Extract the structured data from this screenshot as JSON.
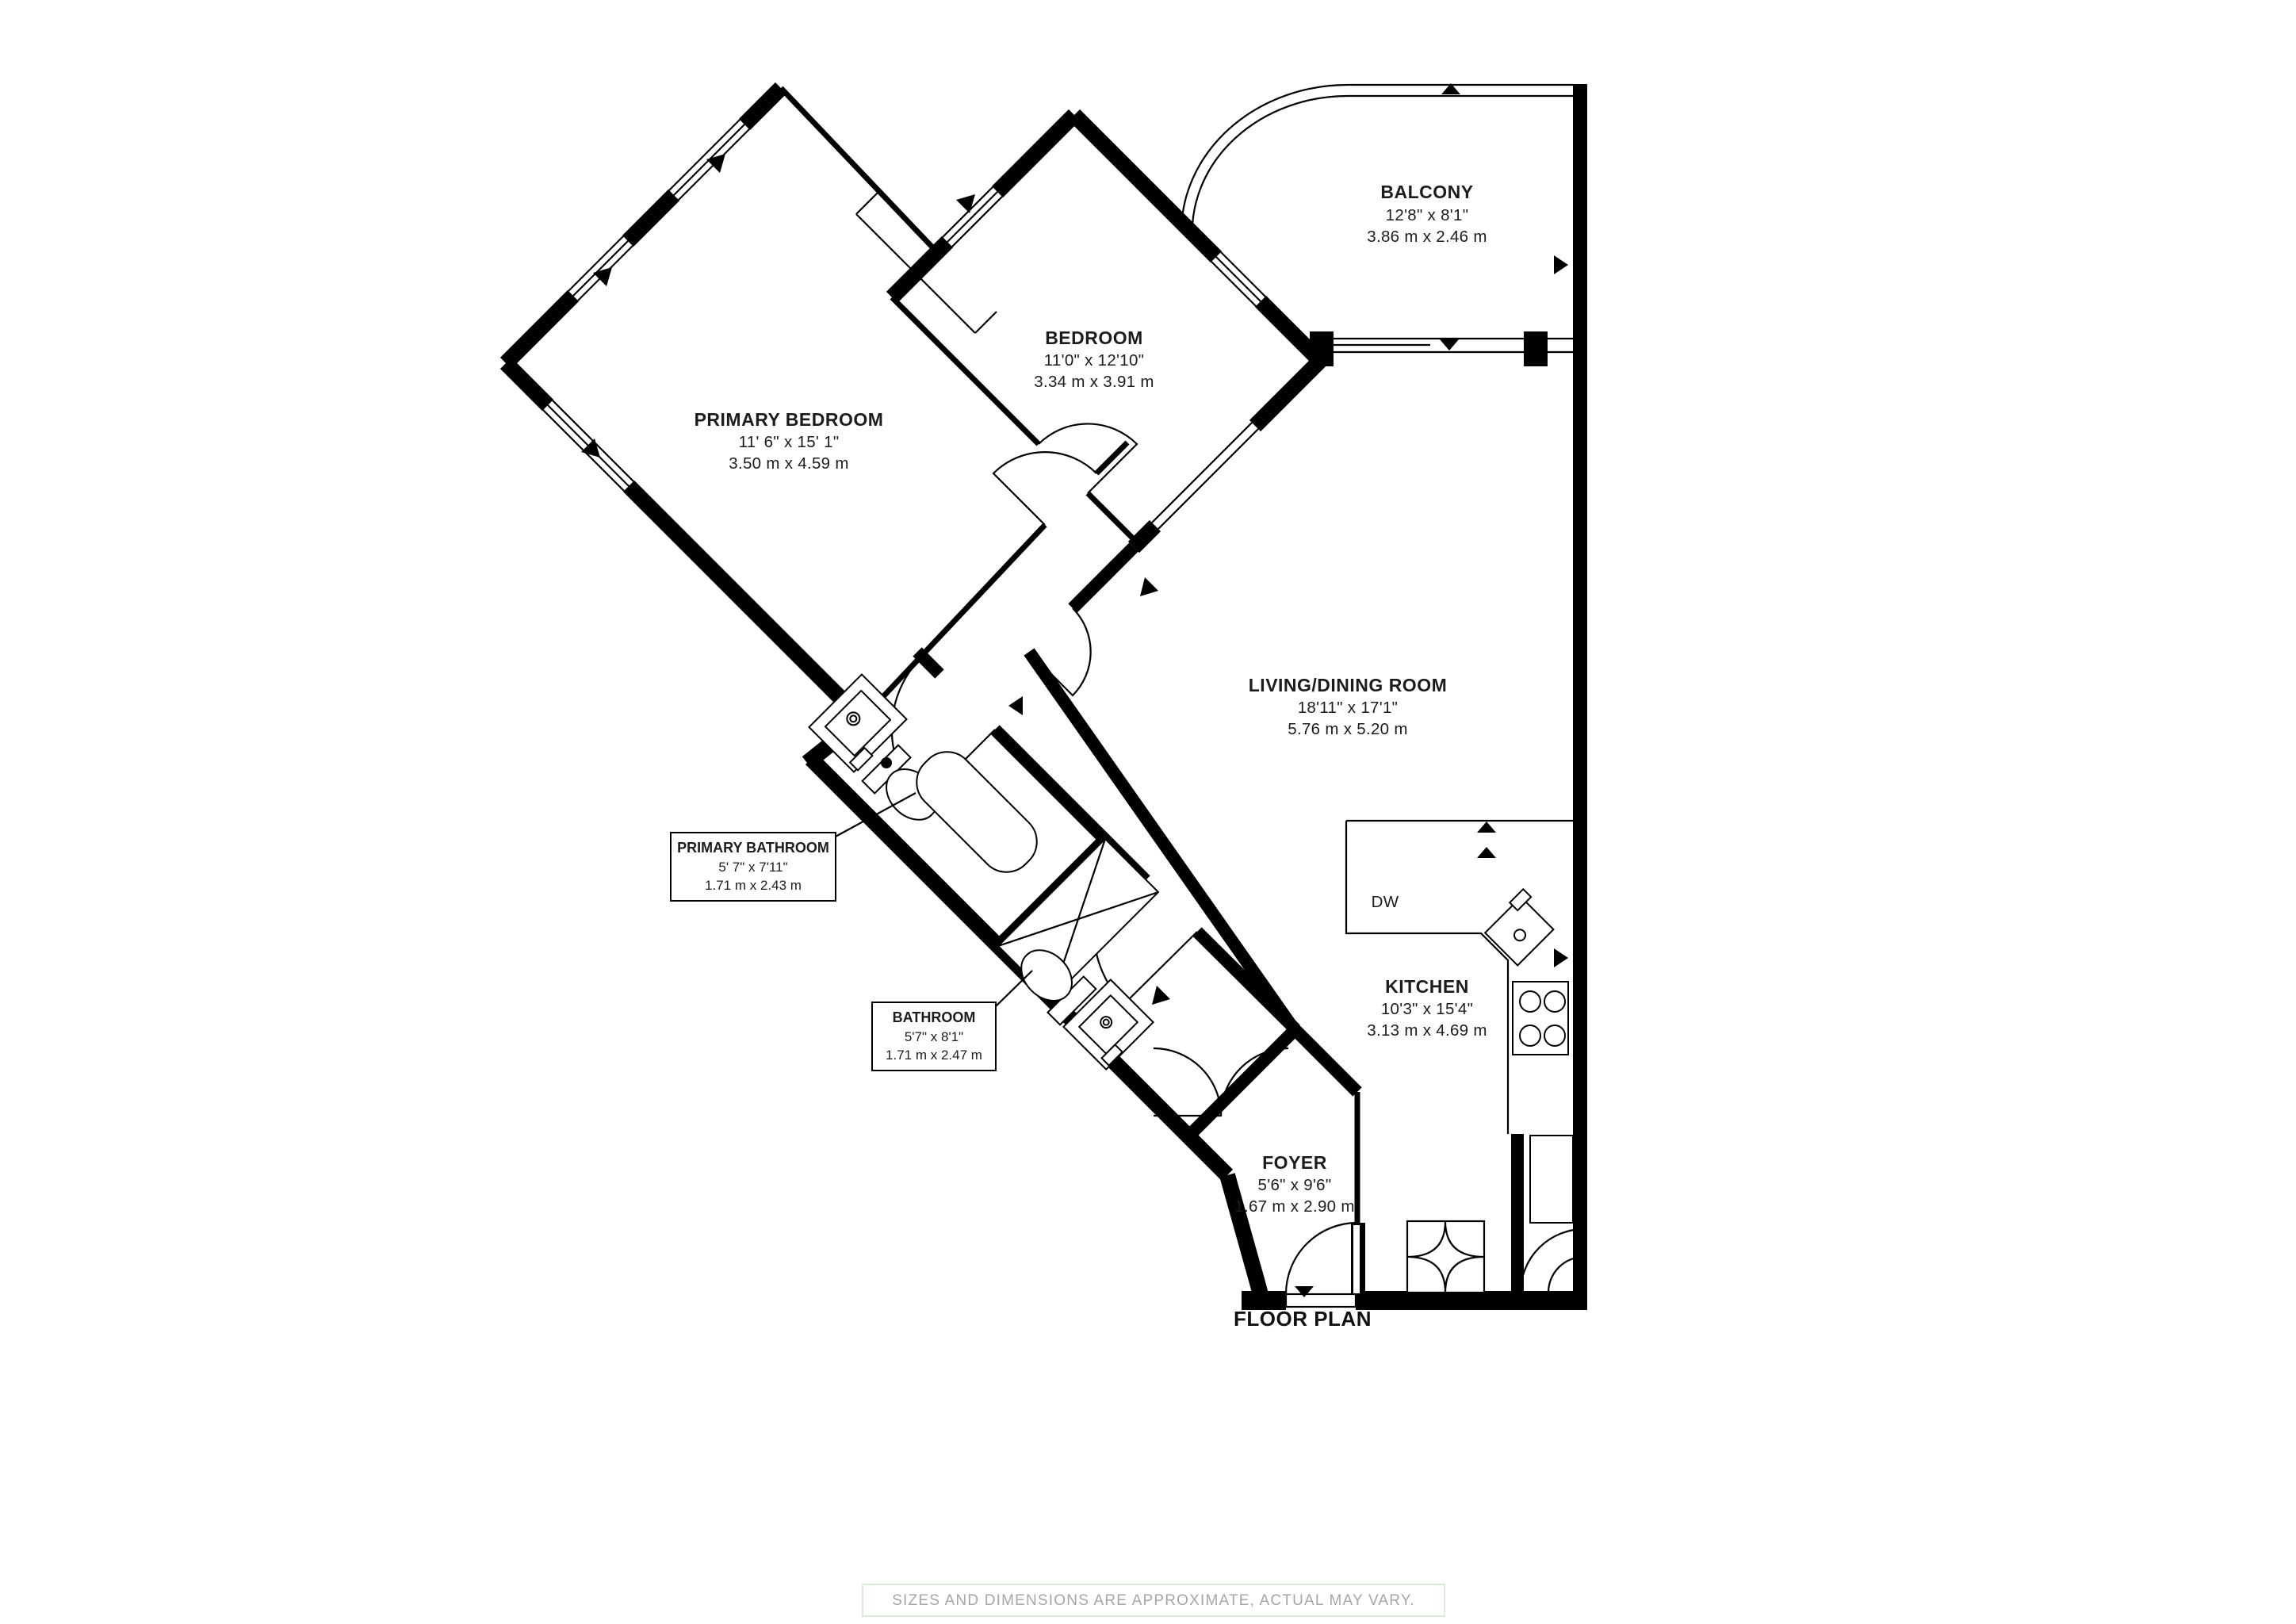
{
  "title": "FLOOR PLAN",
  "disclaimer": "SIZES AND DIMENSIONS ARE APPROXIMATE, ACTUAL MAY VARY.",
  "rooms": {
    "balcony": {
      "name": "BALCONY",
      "imperial": "12'8\" x 8'1\"",
      "metric": "3.86 m x 2.46 m"
    },
    "bedroom": {
      "name": "BEDROOM",
      "imperial": "11'0\" x 12'10\"",
      "metric": "3.34 m x 3.91 m"
    },
    "primary_bedroom": {
      "name": "PRIMARY BEDROOM",
      "imperial": "11' 6\" x 15' 1\"",
      "metric": "3.50 m x 4.59 m"
    },
    "living_dining": {
      "name": "LIVING/DINING ROOM",
      "imperial": "18'11\" x 17'1\"",
      "metric": "5.76 m x 5.20 m"
    },
    "kitchen": {
      "name": "KITCHEN",
      "imperial": "10'3\" x 15'4\"",
      "metric": "3.13 m x 4.69 m"
    },
    "foyer": {
      "name": "FOYER",
      "imperial": "5'6\" x 9'6\"",
      "metric": "1.67 m x 2.90 m"
    },
    "primary_bathroom": {
      "name": "PRIMARY BATHROOM",
      "imperial": "5' 7\" x 7'11\"",
      "metric": "1.71 m x 2.43 m"
    },
    "bathroom": {
      "name": "BATHROOM",
      "imperial": "5'7\" x 8'1\"",
      "metric": "1.71 m x 2.47 m"
    }
  },
  "appliances": {
    "dishwasher": "DW"
  },
  "colors": {
    "wall": "#000000",
    "text": "#1c1c1c",
    "muted": "#a6a6a6",
    "disclaimer_border": "#dcead9"
  }
}
